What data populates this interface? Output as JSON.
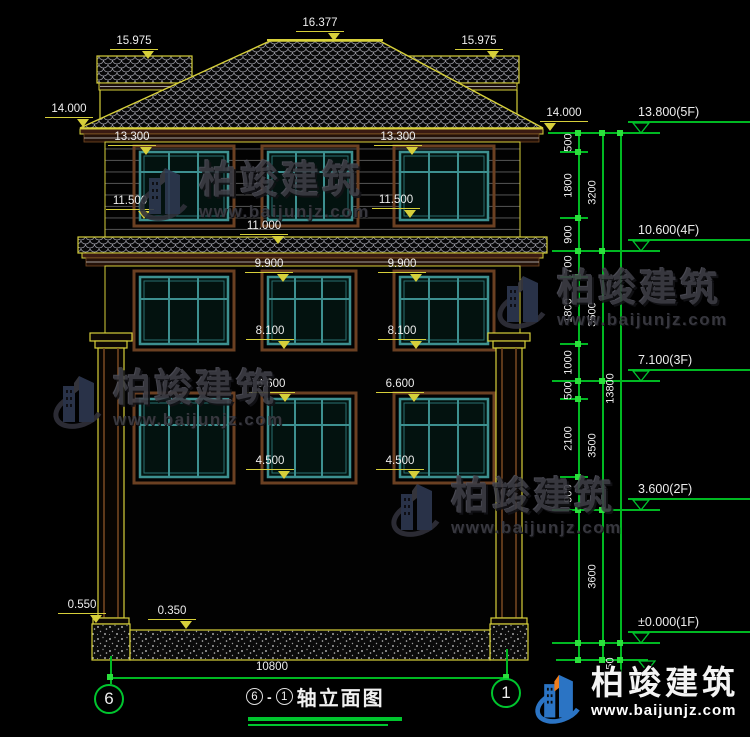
{
  "watermark": {
    "brand": "柏竣建筑",
    "url": "www.baijunjz.com"
  },
  "callouts": [
    "16.377",
    "15.975",
    "15.975",
    "14.000",
    "14.000",
    "13.300",
    "13.300",
    "11.500",
    "11.500",
    "11.000",
    "9.900",
    "9.900",
    "8.100",
    "8.100",
    "6.600",
    "6.600",
    "4.500",
    "4.500",
    "0.550",
    "0.350"
  ],
  "right_dims": {
    "segments_inner": [
      "500",
      "1800",
      "900",
      "700",
      "1800",
      "1000",
      "500",
      "2100",
      "900"
    ],
    "segments_mid": [
      "3200",
      "3500",
      "3500",
      "3600"
    ],
    "total": "13800",
    "below_grade": "450",
    "levels": [
      "13.800(5F)",
      "10.600(4F)",
      "7.100(3F)",
      "3.600(2F)",
      "±0.000(1F)"
    ]
  },
  "grid_bubbles": {
    "left": "6",
    "right": "1"
  },
  "footer": {
    "span_dim": "10800",
    "axis_a": "6",
    "axis_b": "1",
    "title": "轴立面图"
  },
  "colors": {
    "cad_yellow": "#d6cf3a",
    "cad_green": "#00b822",
    "window_teal": "#3d9090",
    "trim_brown": "#6b4022",
    "logo_blue": "#2b74c4",
    "logo_orange": "#ed7d1d"
  }
}
